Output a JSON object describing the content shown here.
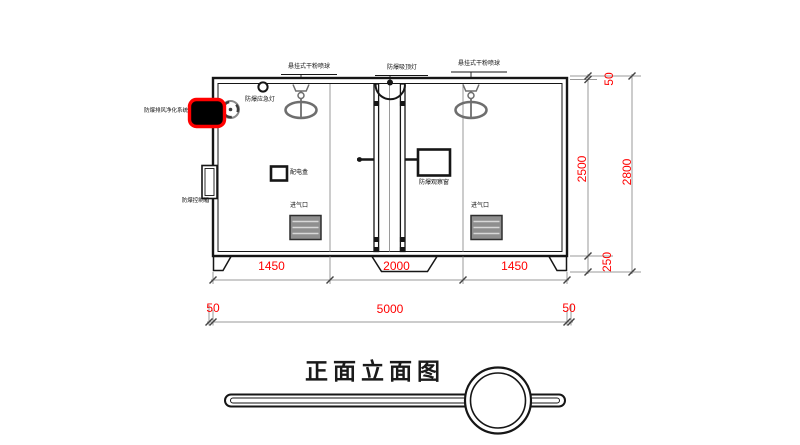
{
  "drawing_title": "正面立面图",
  "labels": {
    "sprinkler": "悬挂式干粉喷球",
    "ceiling_light": "防爆吸顶灯",
    "emergency_light": "防爆应急灯",
    "purifier_system": "防爆排风净化系统",
    "control_box": "防爆控制箱",
    "power_box": "配电盒",
    "observation_window": "防爆观察窗",
    "air_inlet": "进气口"
  },
  "dimensions": {
    "bottom_sections": [
      "1450",
      "2000",
      "1450"
    ],
    "bottom_overall": [
      "50",
      "5000",
      "50"
    ],
    "right_sections": [
      "50",
      "2500",
      "250"
    ],
    "right_overall": "2800"
  },
  "colors": {
    "dimension_text": "#ff0000",
    "highlight_outline": "#ff0000",
    "linework": "#161616",
    "thin_lines": "#9a9a9a"
  }
}
